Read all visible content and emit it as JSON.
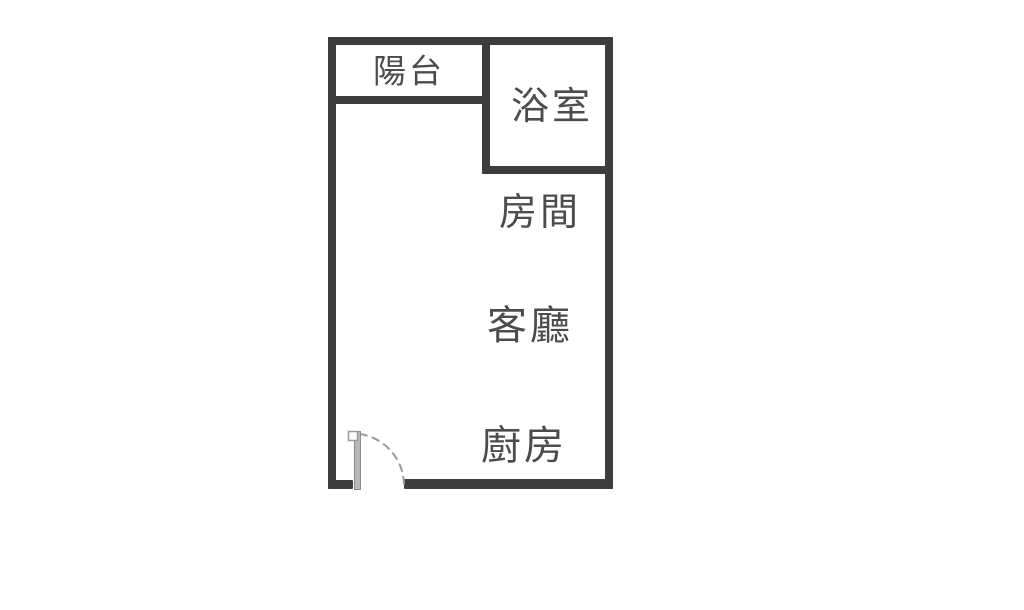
{
  "diagram_type": "apartment-floor-plan",
  "rooms": [
    {
      "id": "balcony",
      "label": "陽台"
    },
    {
      "id": "bathroom",
      "label": "浴室"
    },
    {
      "id": "bedroom",
      "label": "房間"
    },
    {
      "id": "living_room",
      "label": "客廳"
    },
    {
      "id": "kitchen",
      "label": "廚房"
    }
  ],
  "features": [
    {
      "id": "entry_door",
      "type": "swing-door",
      "location": "bottom-left"
    }
  ],
  "colors": {
    "wall": "#3d3d3d",
    "text": "#4c4c4c",
    "door_leaf": "#b8b8b8",
    "door_leaf_edge": "#8a8a8a",
    "door_arc": "#9a9a9a",
    "bg": "#ffffff"
  }
}
